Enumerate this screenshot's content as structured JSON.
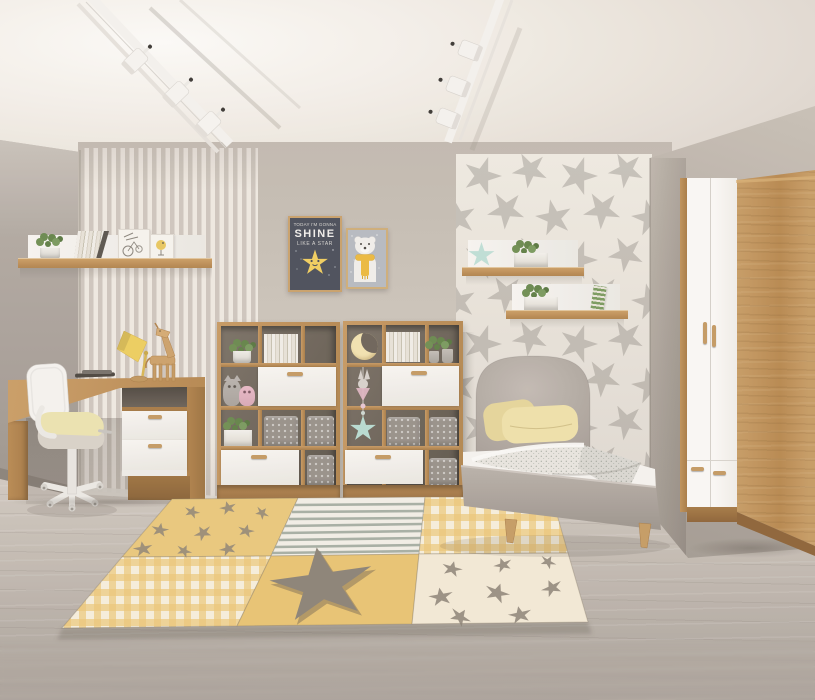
{
  "scene": {
    "type": "interior-photo",
    "subject": "kids bedroom with oak and white furniture"
  },
  "posters": {
    "shine_poster": {
      "line1": "TODAY I'M GONNA",
      "line2": "SHINE",
      "line3": "LIKE A STAR"
    },
    "bear_poster": {
      "subject": "polar bear with yellow scarf"
    }
  },
  "objects": [
    "ceiling-track-lights",
    "striped-wallpaper",
    "star-wallpaper",
    "wall-shelf",
    "shine-poster",
    "bear-poster",
    "desk",
    "office-chair",
    "desk-lamp",
    "giraffe-figurine",
    "bookshelf-left",
    "bookshelf-right",
    "star-wall-shelf-upper",
    "star-wall-shelf-lower",
    "bed",
    "pillow",
    "blanket",
    "wardrobe",
    "patchwork-rug",
    "floor"
  ],
  "colors": {
    "ceiling": "#e8e2d9",
    "wall_main": "#c9c1b7",
    "wall_left": "#ada59c",
    "wall_right": "#b4aca2",
    "stripe_light": "#f0eae2",
    "stripe_dark": "#cfc7be",
    "star_wall_bg": "#f0ebe2",
    "star_gray": "#c7c2ba",
    "floor": "#c6beb5",
    "wood": "#c0935a",
    "wood_dark": "#a87c46",
    "white_furniture": "#f7f5f1",
    "cubby": "#6e665b",
    "drawer_handle": "#c59a62",
    "basket": "#98928a",
    "bed_gray": "#b5ada5",
    "headboard": "#b8b0a8",
    "pillow": "#f0e2aa",
    "mattress": "#f6f4f0",
    "blanket": "#e7e4de",
    "rug_yellow": "#eac97c",
    "rug_yellow_deep": "#e9c472",
    "rug_cream": "#f4ead6",
    "rug_gingham": "#ecc778",
    "rug_star": "#8c8376",
    "rug_stripe": "#9fa89d",
    "chair_white": "#f0eee9",
    "chair_seat": "#ece4b0",
    "lamp": "#eecf5e",
    "plant": "#6b8b4e",
    "toy_gray": "#b9b3ad",
    "toy_pink": "#e9bac7",
    "star_teal": "#bfe0d6",
    "poster_dark": "#4a4f5a",
    "poster_star": "#f2cf5e",
    "poster_bear_bg": "#b7bbc1",
    "scarf": "#ecba3e",
    "track_white": "#f5f3ef"
  }
}
